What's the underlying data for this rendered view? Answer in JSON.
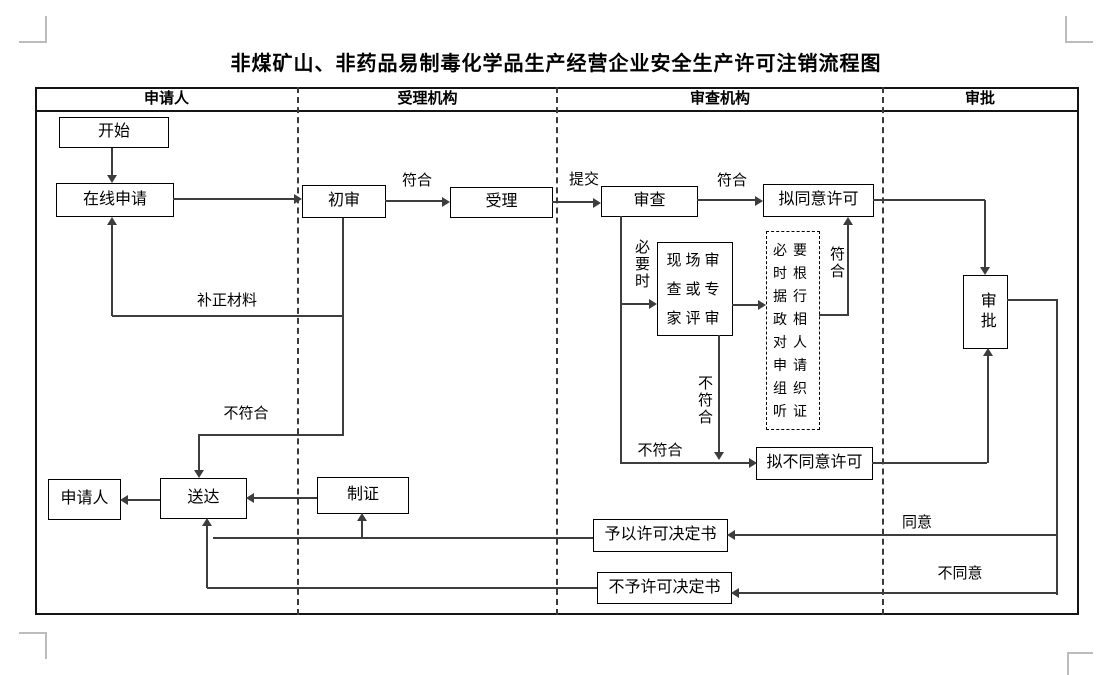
{
  "title": "非煤矿山、非药品易制毒化学品生产经营企业安全生产许可注销流程图",
  "lanes": {
    "applicant": "申请人",
    "accepting": "受理机构",
    "reviewing": "审查机构",
    "approval": "审批"
  },
  "nodes": {
    "start": "开始",
    "online_apply": "在线申请",
    "initial_review": "初审",
    "accept": "受理",
    "review": "审查",
    "onsite_review": "现场审查或专家评审",
    "propose_approve": "拟同意许可",
    "hearing": "必要时根据行政相对人申请组织听证",
    "approve": "审批",
    "propose_deny": "拟不同意许可",
    "applicant": "申请人",
    "deliver": "送达",
    "make_certificate": "制证",
    "grant_decision": "予以许可决定书",
    "deny_decision": "不予许可决定书"
  },
  "edge_labels": {
    "conform_initial": "符合",
    "submit": "提交",
    "conform_review": "符合",
    "supplement_materials": "补正材料",
    "nonconform_initial": "不符合",
    "when_necessary": "必要时",
    "nonconform_onsite": "不符合",
    "nonconform_review": "不符合",
    "conform_hearing": "符合",
    "agree": "同意",
    "disagree": "不同意"
  },
  "colors": {
    "line": "#3d3d3d",
    "box_border": "#000000",
    "frame_border": "#141414",
    "crop_mark": "#bcbcbc"
  }
}
